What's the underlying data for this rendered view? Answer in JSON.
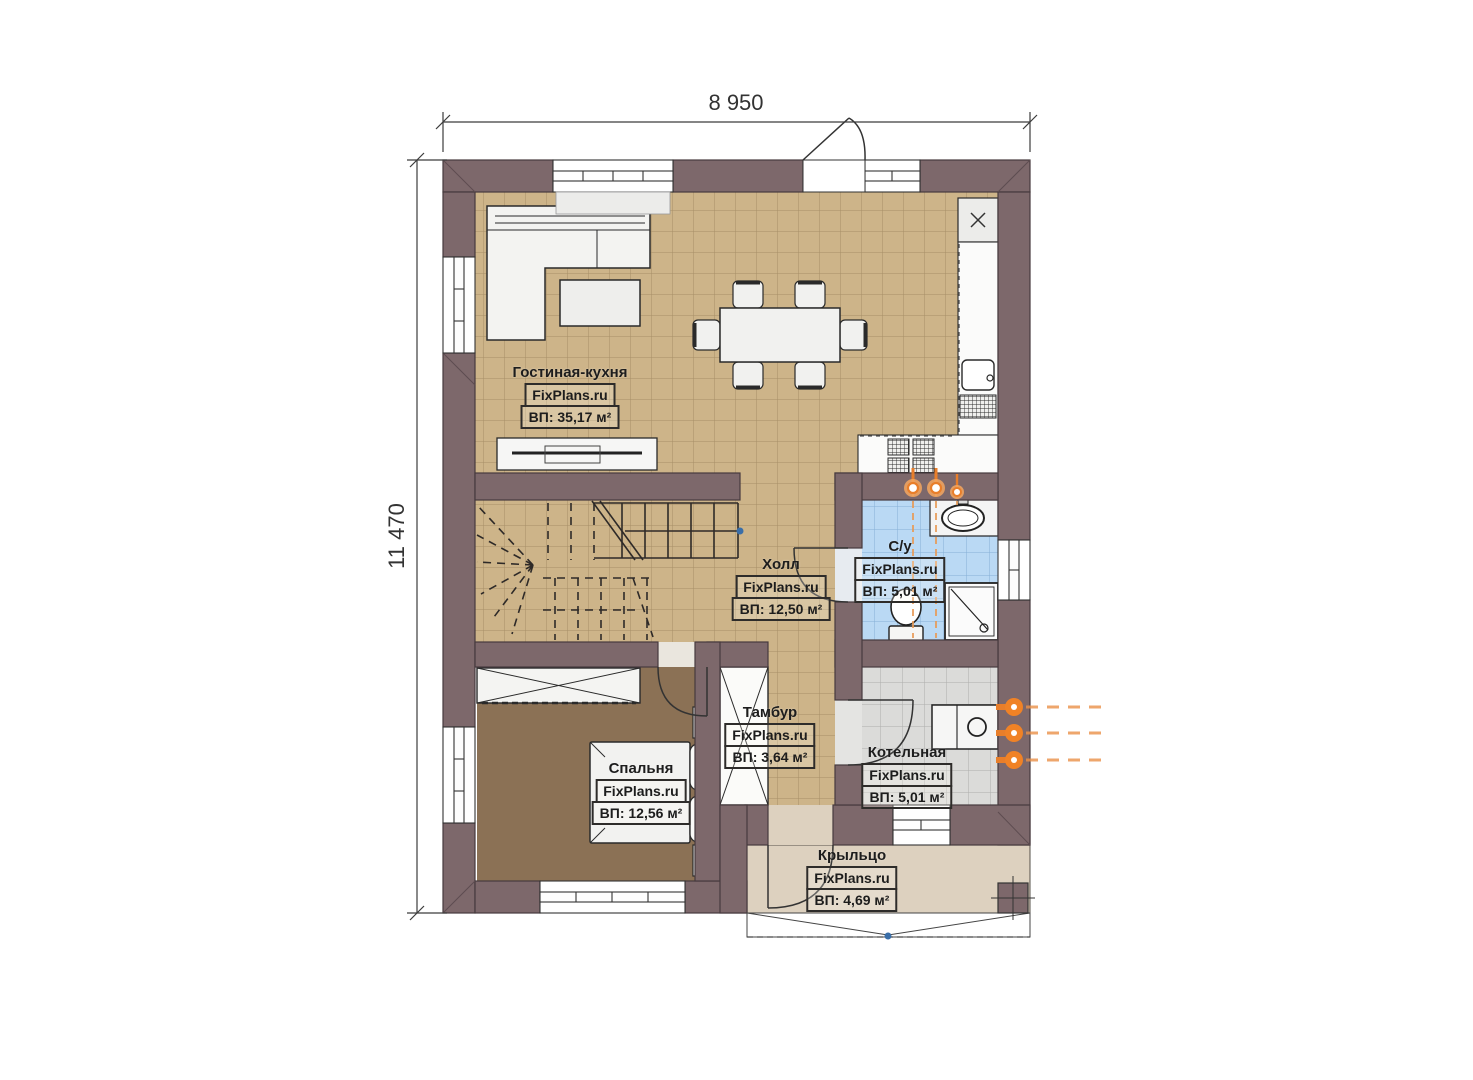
{
  "plan": {
    "title": "Floor plan (first floor)",
    "brand": "FixPlans.ru",
    "dimension_width": "8 950",
    "dimension_height": "11 470",
    "rooms": [
      {
        "id": "living",
        "name": "Гостиная-кухня",
        "source": "FixPlans.ru",
        "area": "ВП: 35,17 м²"
      },
      {
        "id": "hall",
        "name": "Холл",
        "source": "FixPlans.ru",
        "area": "ВП: 12,50 м²"
      },
      {
        "id": "bathroom",
        "name": "С/у",
        "source": "FixPlans.ru",
        "area": "ВП: 5,01 м²"
      },
      {
        "id": "tambour",
        "name": "Тамбур",
        "source": "FixPlans.ru",
        "area": "ВП: 3,64 м²"
      },
      {
        "id": "boiler",
        "name": "Котельная",
        "source": "FixPlans.ru",
        "area": "ВП: 5,01 м²"
      },
      {
        "id": "bedroom",
        "name": "Спальня",
        "source": "FixPlans.ru",
        "area": "ВП: 12,56 м²"
      },
      {
        "id": "porch",
        "name": "Крыльцо",
        "source": "FixPlans.ru",
        "area": "ВП: 4,69 м²"
      }
    ],
    "colors": {
      "wall": "#7d686b",
      "floor_tile_tan": "#cdb489",
      "bathroom_tile_blue": "#bad9f4",
      "boiler_tile_gray": "#dbdbd9",
      "bedroom_floor_brown": "#8b7155",
      "porch_floor_beige": "#ddd1bf",
      "plumbing_orange": "#e87e2a",
      "stair_marker_blue": "#3a6ea8"
    }
  }
}
